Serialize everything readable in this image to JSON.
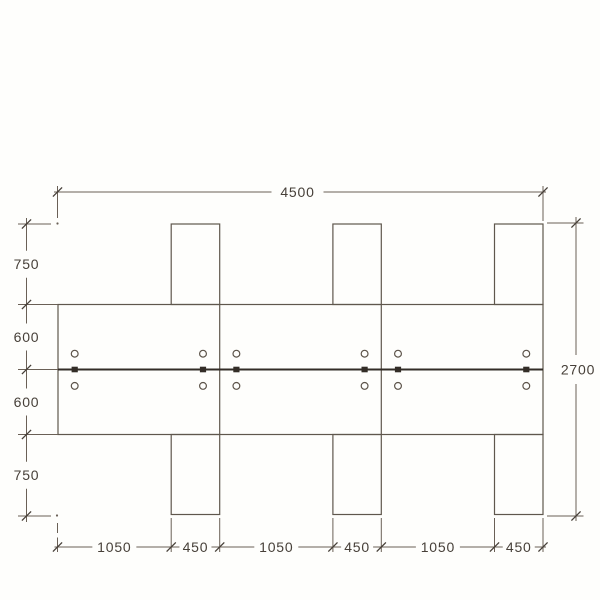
{
  "page": {
    "background": "#fefefc",
    "description_label": "dimensioned plan drawing"
  },
  "colors": {
    "line": "#6a6056",
    "outline": "#5f574d",
    "text": "#474039",
    "rail": "#332d27",
    "connector": "#332d27",
    "hole_stroke": "#5c5349",
    "background": "#fefefc"
  },
  "dimensions": {
    "top": {
      "label": "4500"
    },
    "right": {
      "label": "2700"
    },
    "left": {
      "labels": [
        "750",
        "600",
        "600",
        "750"
      ]
    },
    "bottom": {
      "labels": [
        "1050",
        "450",
        "1050",
        "450",
        "1050",
        "450"
      ]
    }
  },
  "drawing": {
    "overall_width_label": "4500",
    "overall_height_label": "2700",
    "panel_count": 3,
    "top_tab_count": 3,
    "bottom_tab_count": 3,
    "hardware_group_count": 6,
    "holes_per_group": 2,
    "connectors_per_group": 1
  }
}
